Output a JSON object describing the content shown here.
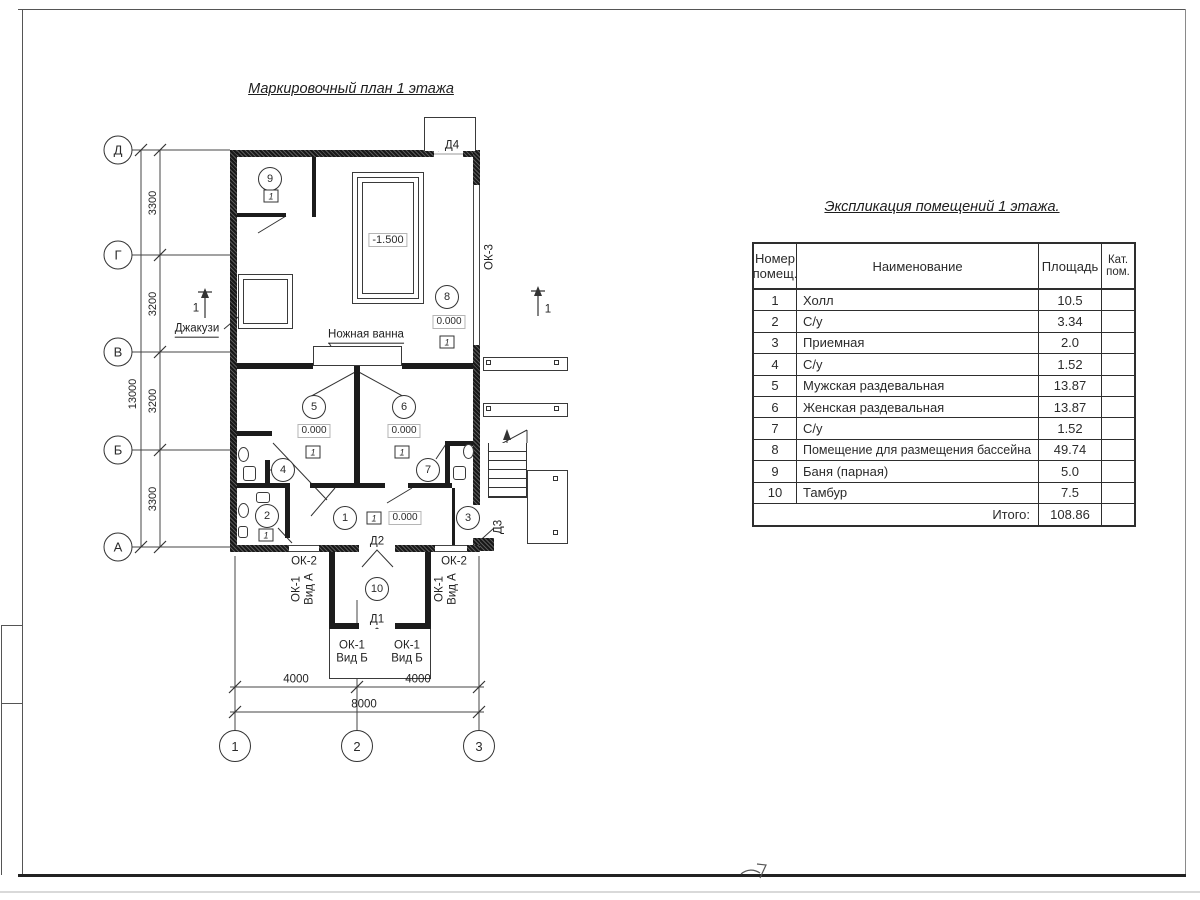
{
  "plan": {
    "title": "Маркировочный план 1 этажа",
    "labels": {
      "jacuzzi": "Джакузи",
      "foot_bath": "Ножная ванна",
      "pool_level": "-1.500",
      "level_zero": "0.000",
      "d1": "Д1",
      "d2": "Д2",
      "d3": "Д3",
      "d4": "Д4",
      "ok1": "ОК-1",
      "view_a": "Вид А",
      "view_b": "Вид Б",
      "ok2": "ОК-2",
      "ok3": "ОК-3",
      "floor_type": "1",
      "section_mark": "1"
    },
    "rooms": [
      "1",
      "2",
      "3",
      "4",
      "5",
      "6",
      "7",
      "8",
      "9",
      "10"
    ],
    "axes_vertical": [
      "Д",
      "Г",
      "В",
      "Б",
      "А"
    ],
    "axes_horizontal": [
      "1",
      "2",
      "3"
    ],
    "dims_left": [
      "3300",
      "3200",
      "3200",
      "3300"
    ],
    "dim_left_total": "13000",
    "dims_bottom": [
      "4000",
      "4000"
    ],
    "dim_bottom_total": "8000"
  },
  "table": {
    "title": "Экспликация помещений 1 этажа.",
    "headers": {
      "num": "Номер помещ.",
      "name": "Наименование",
      "area": "Площадь",
      "cat": "Кат. пом."
    },
    "rows": [
      {
        "num": "1",
        "name": "Холл",
        "area": "10.5",
        "cat": ""
      },
      {
        "num": "2",
        "name": "С/у",
        "area": "3.34",
        "cat": ""
      },
      {
        "num": "3",
        "name": "Приемная",
        "area": "2.0",
        "cat": ""
      },
      {
        "num": "4",
        "name": "С/у",
        "area": "1.52",
        "cat": ""
      },
      {
        "num": "5",
        "name": "Мужская раздевальная",
        "area": "13.87",
        "cat": ""
      },
      {
        "num": "6",
        "name": "Женская раздевальная",
        "area": "13.87",
        "cat": ""
      },
      {
        "num": "7",
        "name": "С/у",
        "area": "1.52",
        "cat": ""
      },
      {
        "num": "8",
        "name": "Помещение для размещения бассейна",
        "area": "49.74",
        "cat": ""
      },
      {
        "num": "9",
        "name": "Баня (парная)",
        "area": "5.0",
        "cat": ""
      },
      {
        "num": "10",
        "name": "Тамбур",
        "area": "7.5",
        "cat": ""
      }
    ],
    "total_label": "Итого:",
    "total_value": "108.86"
  }
}
